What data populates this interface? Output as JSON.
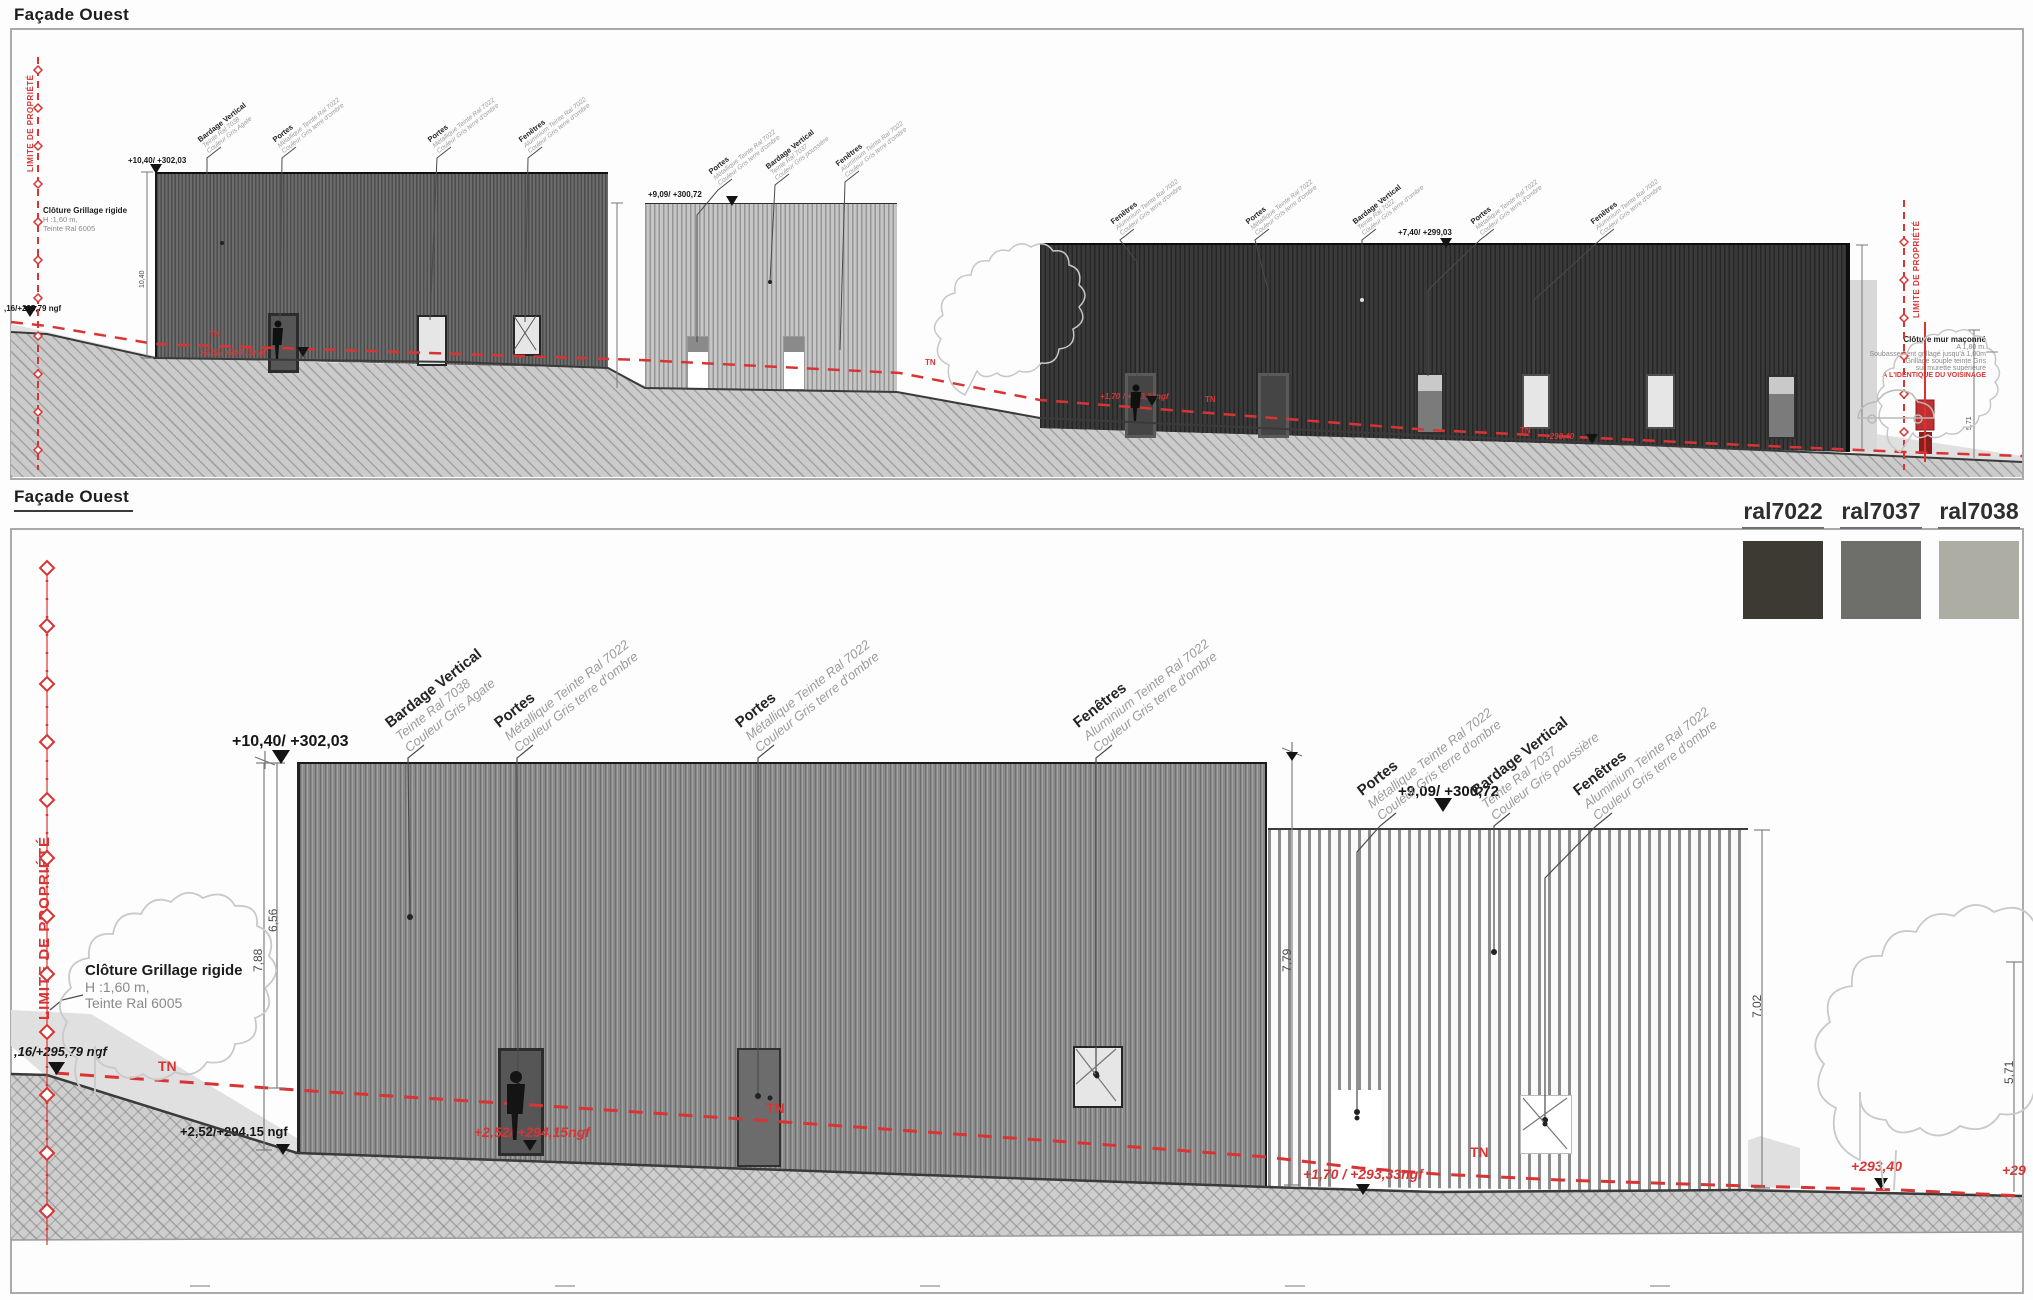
{
  "app": {
    "title_top": "Façade Ouest",
    "title_bottom": "Façade Ouest"
  },
  "legend": {
    "swatches": [
      {
        "label": "ral7022",
        "color": "#3c3a33"
      },
      {
        "label": "ral7037",
        "color": "#6e6e6b"
      },
      {
        "label": "ral7038",
        "color": "#adada4"
      }
    ]
  },
  "materials": {
    "bardage7038": {
      "title": "Bardage Vertical",
      "line2": "Teinte Ral 7038",
      "line3": "Couleur Gris Agate"
    },
    "bardage7037": {
      "title": "Bardage Vertical",
      "line2": "Teinte Ral 7037",
      "line3": "Couleur Gris poussière"
    },
    "bardage7022": {
      "title": "Bardage Vertical",
      "line2": "Teinte Ral 7022",
      "line3": "Couleur Gris terre d'ombre"
    },
    "portes": {
      "title": "Portes",
      "line2": "Métallique Teinte Ral 7022",
      "line3": "Couleur Gris terre d'ombre"
    },
    "fenetres": {
      "title": "Fenêtres",
      "line2": "Aluminium Teinte Ral 7022",
      "line3": "Couleur Gris terre d'ombre"
    }
  },
  "fence_note": {
    "title": "Clôture Grillage rigide",
    "line2": "H :1,60 m,",
    "line3": "Teinte Ral 6005"
  },
  "right_note": {
    "line1": "Clôture mur maçonné",
    "line2": "A 1,80 m.",
    "line3": "Soubassement grillagé jusqu'à 1,00m",
    "line4": "Grillage souple teinte Gris",
    "line5": "sur murette supérieure",
    "line6": "A L'IDENTIQUE DU VOISINAGE"
  },
  "property_limit_label": "LIMITE DE PROPRIÉTÉ",
  "levels": {
    "top_of_main": "+10,40/ +302,03",
    "top_of_second": "+9,09/ +300,72",
    "top_of_third": "+7,40/ +299,03",
    "ngf_left": ",16/+295,79 ngf",
    "base_left": "+2,52/+294,15 ngf",
    "door1_red": "+2,52/ +294,15ngf",
    "door3_red": "+1,70 / +293,33ngf",
    "right_red": "+293,40",
    "right_red_clipped": "+29",
    "tn": "TN"
  },
  "dimensions": {
    "d1": "6,56",
    "d2": "7,88",
    "d3": "7,79",
    "d4": "7,02",
    "d5": "5,71",
    "d6": "10,40"
  }
}
